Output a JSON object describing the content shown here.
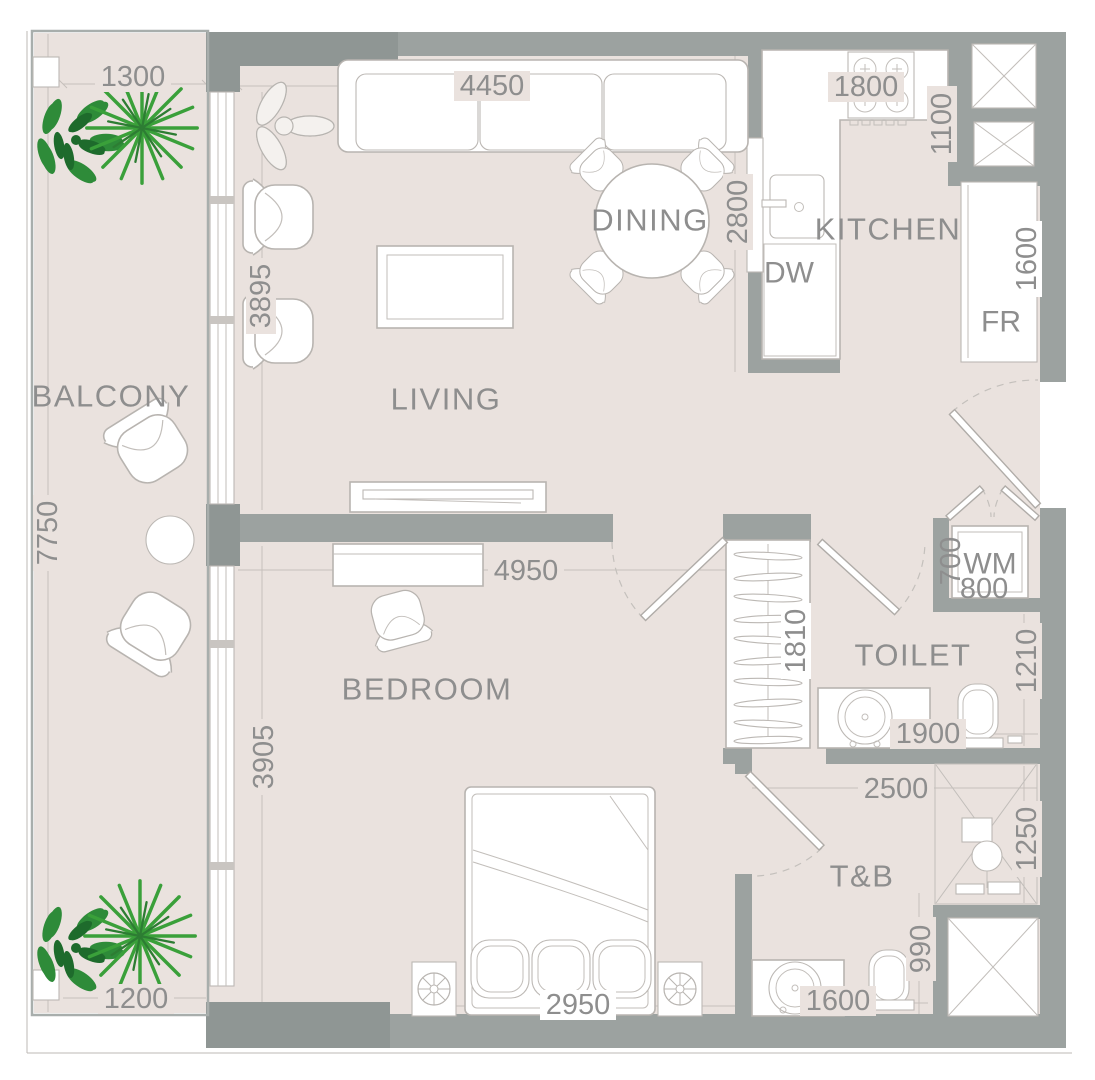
{
  "rooms": {
    "balcony": "BALCONY",
    "living": "LIVING",
    "dining": "DINING",
    "kitchen": "KITCHEN",
    "bedroom": "BEDROOM",
    "toilet": "TOILET",
    "tb": "T&B"
  },
  "appliances": {
    "dw": "DW",
    "fr": "FR",
    "wm": "WM"
  },
  "dims": {
    "balcony_top": "1300",
    "living_width": "4450",
    "kitchen_width": "1800",
    "shaft_height": "1100",
    "kitchen_depth": "2800",
    "fridge_side": "1600",
    "living_side": "3895",
    "balcony_height": "7750",
    "bedroom_width": "4950",
    "wardrobe": "1810",
    "wm_depth": "700",
    "wm_width": "800",
    "toilet_side": "1210",
    "toilet_width": "1900",
    "tb_width": "2500",
    "shower_side": "1250",
    "tb_wc": "990",
    "tb_basin": "1600",
    "bedroom_side": "3905",
    "bed_width": "2950",
    "balcony_bottom": "1200"
  },
  "colors": {
    "floor": "#eae2de",
    "wall": "#9ca2a0",
    "wall_dark": "#8f9694",
    "outline": "#b8b4b0",
    "dim_line": "#c6c0bc",
    "text": "#8e8e8e",
    "plant_light": "#3aa03a",
    "plant_dark": "#2d7d33"
  }
}
